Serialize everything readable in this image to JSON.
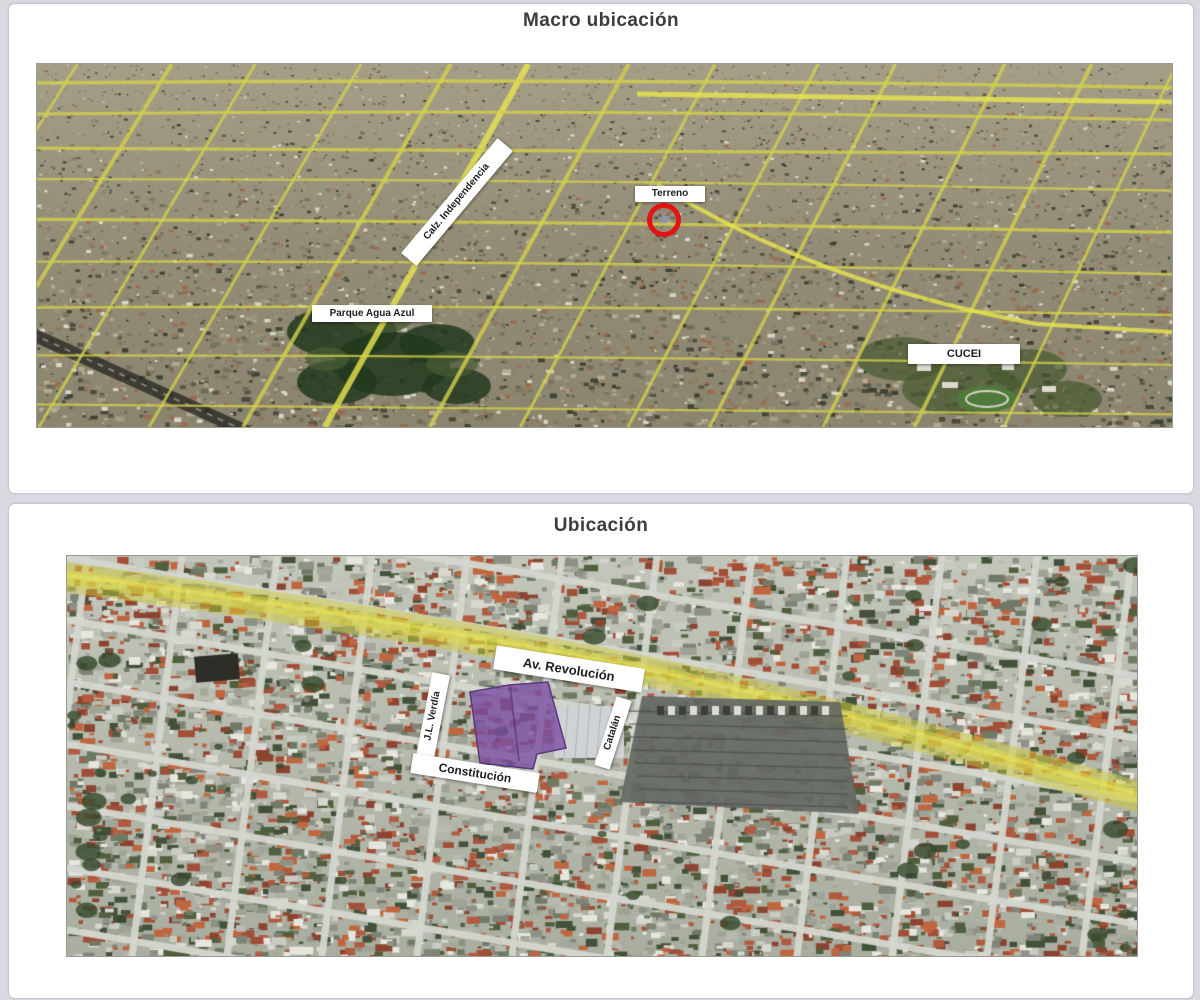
{
  "page": {
    "background": "#d9d9e1"
  },
  "panels": [
    {
      "title": "Macro ubicación",
      "labels": {
        "calz_independencia": "Calz. Independencia",
        "terreno": "Terreno",
        "parque_agua_azul": "Parque Agua Azul",
        "cucei": "CUCEI"
      },
      "marker_color": "#e21313"
    },
    {
      "title": "Ubicación",
      "labels": {
        "av_revolucion": "Av. Revolución",
        "jl_verdia": "J.L. Verdía",
        "constitucion": "Constitución",
        "catalan": "Catalán"
      },
      "highlight_color": "#7b4ea3",
      "road_highlight_color": "#d8d44a"
    }
  ]
}
